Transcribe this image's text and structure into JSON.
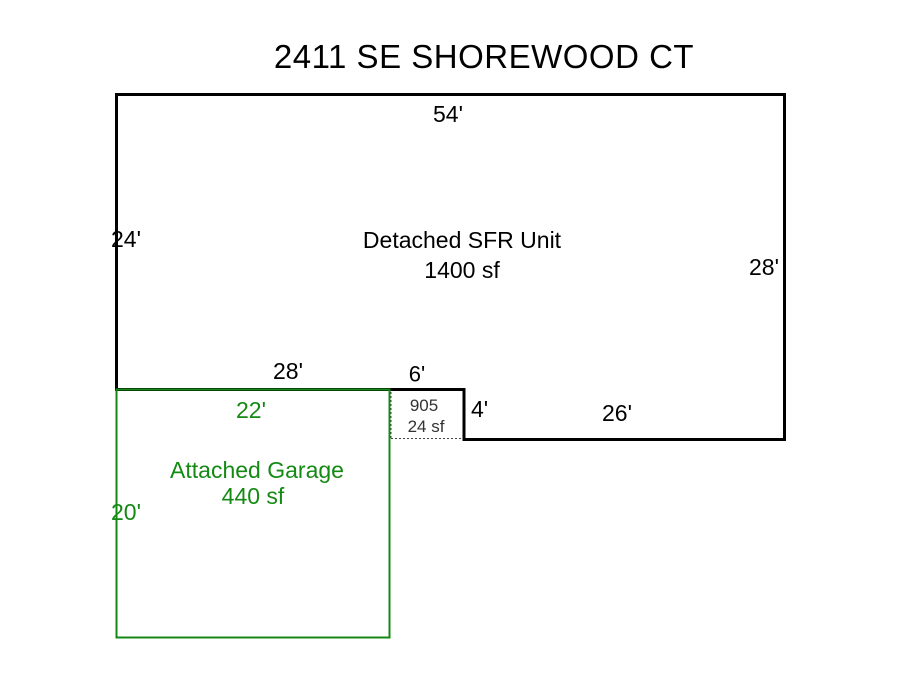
{
  "title": "2411 SE SHOREWOOD CT",
  "colors": {
    "main_outline": "#000000",
    "garage_outline": "#148a14",
    "garage_text": "#148a14",
    "porch_text": "#333333"
  },
  "main_unit": {
    "label": "Detached SFR Unit",
    "area": "1400 sf",
    "dim_top": "54'",
    "dim_left": "24'",
    "dim_right": "28'",
    "dim_bottom_west": "28'",
    "dim_notch_top": "6'",
    "dim_notch_right": "4'",
    "dim_bottom_east": "26'"
  },
  "garage": {
    "label": "Attached Garage",
    "area": "440 sf",
    "dim_top": "22'",
    "dim_left": "20'"
  },
  "porch": {
    "code": "905",
    "area": "24 sf"
  }
}
